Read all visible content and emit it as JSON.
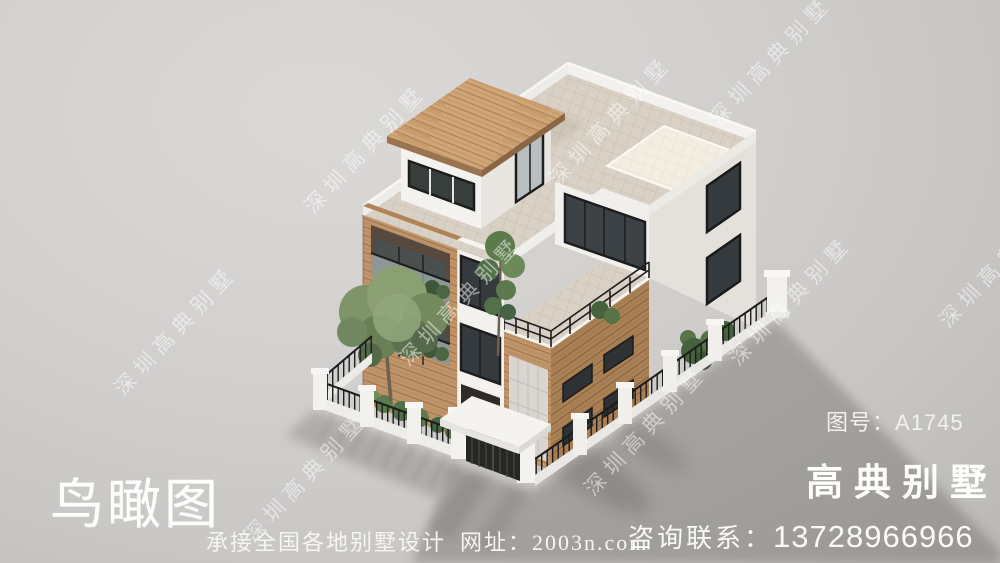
{
  "overlay": {
    "title": "鸟瞰图",
    "tagline_service": "承接全国各地别墅设计",
    "tagline_site": "网址：2003n.com",
    "drawing_no_label": "图号：",
    "drawing_no_value": "A1745",
    "brand": "高典别墅",
    "contact_label": "咨询联系：",
    "contact_number": "13728966966",
    "watermark": "深圳高典别墅"
  },
  "colors": {
    "background": "#d2d0ce",
    "shadow": "#a6a3a0",
    "wood_roof": "#d0a678",
    "wood_wall_lit": "#c0946a",
    "wood_wall_shade": "#aa8055",
    "tile_floor": "#d9d1c5",
    "tile_bright": "#f3eee1",
    "wall_white_lit": "#f3f1ee",
    "wall_white_shade": "#e4e1dc",
    "window_frame": "#1d1d1d",
    "glass": "#3c4245",
    "foliage": "#7f9468",
    "text_white": "#fbfbfa"
  }
}
